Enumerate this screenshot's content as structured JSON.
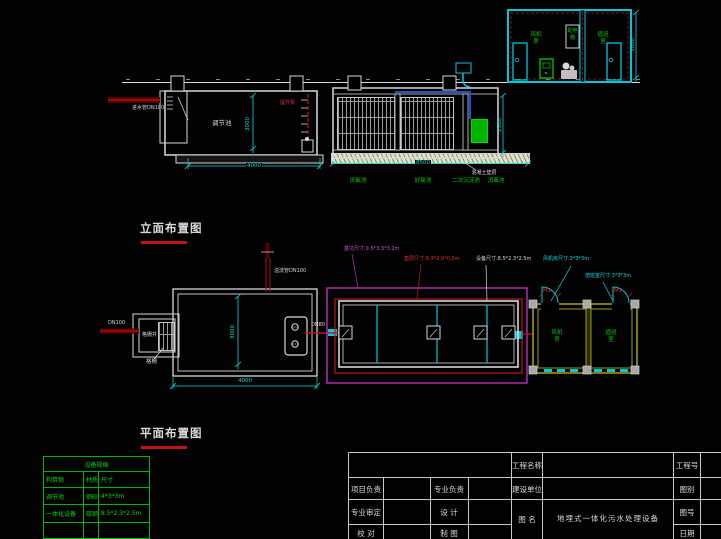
{
  "colors": {
    "background": "#020202",
    "line_white": "#d8d8d8",
    "cyan": "#00dcdc",
    "green": "#00cc00",
    "red": "#c01818",
    "dark_red": "#5a0000",
    "magenta": "#bb2dbb",
    "olive_wall": "#9a9a1a",
    "pipe_blue": "#1b52d8",
    "table_green": "#00b400"
  },
  "elevation": {
    "title": "立面布置图",
    "tank_label": "调节池",
    "inlet_label": "进水管DN100",
    "pump_label": "提升泵",
    "cushion_note": "混凝土垫层",
    "process_labels": [
      "厌氧池",
      "好氧池",
      "二次沉淀池",
      "消毒池"
    ],
    "dims": {
      "tank_width": "4000",
      "tank_depth": "3000",
      "equip_width": "8500",
      "equip_depth": "2500",
      "building_height": "3000"
    },
    "building": {
      "room1_line1": "风机",
      "room1_line2": "房",
      "cabinet_line1": "配电",
      "cabinet_line2": "箱",
      "room2_line1": "值班",
      "room2_line2": "室"
    }
  },
  "plan": {
    "title": "平面布置图",
    "inlet_label": "DN100",
    "overflow_label": "溢流管DN100",
    "grille_well_label": "格栅井",
    "grille_label": "格栅",
    "transfer_pipe_label": "DN80",
    "leaders": {
      "pit": "基坑尺寸:9.5*3.3*3.2m",
      "cushion": "垫层尺寸:9.3*2.9*0.2m",
      "equipment": "设备尺寸:8.5*2.3*2.5m",
      "blower_room": "风机房尺寸:3*3*3m",
      "duty_room": "值班室尺寸:3*3*3m"
    },
    "dims": {
      "tank_width": "4000",
      "tank_depth": "3000"
    },
    "rooms": {
      "room1_line1": "风机",
      "room1_line2": "房",
      "room2_line1": "值班",
      "room2_line2": "室",
      "door_tag_1": "M1",
      "door_tag_2": "M1"
    }
  },
  "spec_table": {
    "header": "设备规格",
    "columns": [
      "构筑物",
      "材质",
      "尺寸"
    ],
    "rows": [
      [
        "调节池",
        "钢砼",
        "4*3*3m"
      ],
      [
        "一体化设备",
        "碳钢",
        "8.5*2.3*2.5m"
      ],
      [
        "",
        "",
        ""
      ]
    ]
  },
  "title_block": {
    "project_name_label": "工程名称",
    "project_no_label": "工程号",
    "project_lead_label": "项目负责",
    "discipline_lead_label": "专业负责",
    "build_unit_label": "建设单位",
    "category_label": "图别",
    "discipline_review_label": "专业审定",
    "design_label": "设 计",
    "drawing_name_label": "图 名",
    "drawing_no_label": "图号",
    "check_label": "校 对",
    "draft_label": "制 图",
    "date_label": "日期",
    "drawing_title": "地埋式一体化污水处理设备"
  }
}
